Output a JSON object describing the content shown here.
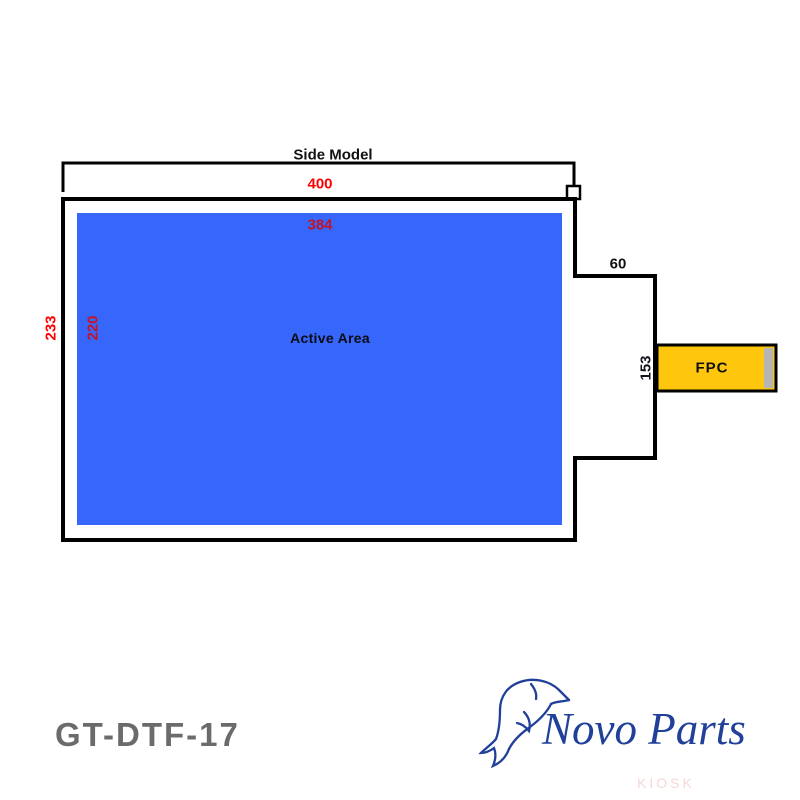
{
  "title": "Side Model",
  "part_number": "GT-DTF-17",
  "active_area": {
    "label": "Active Area"
  },
  "fpc": {
    "label": "FPC"
  },
  "dims": {
    "outer_width": "400",
    "active_width": "384",
    "outer_height": "233",
    "active_height": "220",
    "tab_offset": "60",
    "tab_height": "153"
  },
  "logo": {
    "name": "Novo Parts",
    "watermark": "KIOSK"
  },
  "colors": {
    "active_blue": "#3766FA",
    "fpc_yellow": "#FEC70D",
    "dim_red": "#FF0000",
    "inner_red": "#C41425",
    "logo_navy": "#20409A",
    "part_gray": "#6B6B6B",
    "watermark_pink": "#EDAFAF"
  }
}
